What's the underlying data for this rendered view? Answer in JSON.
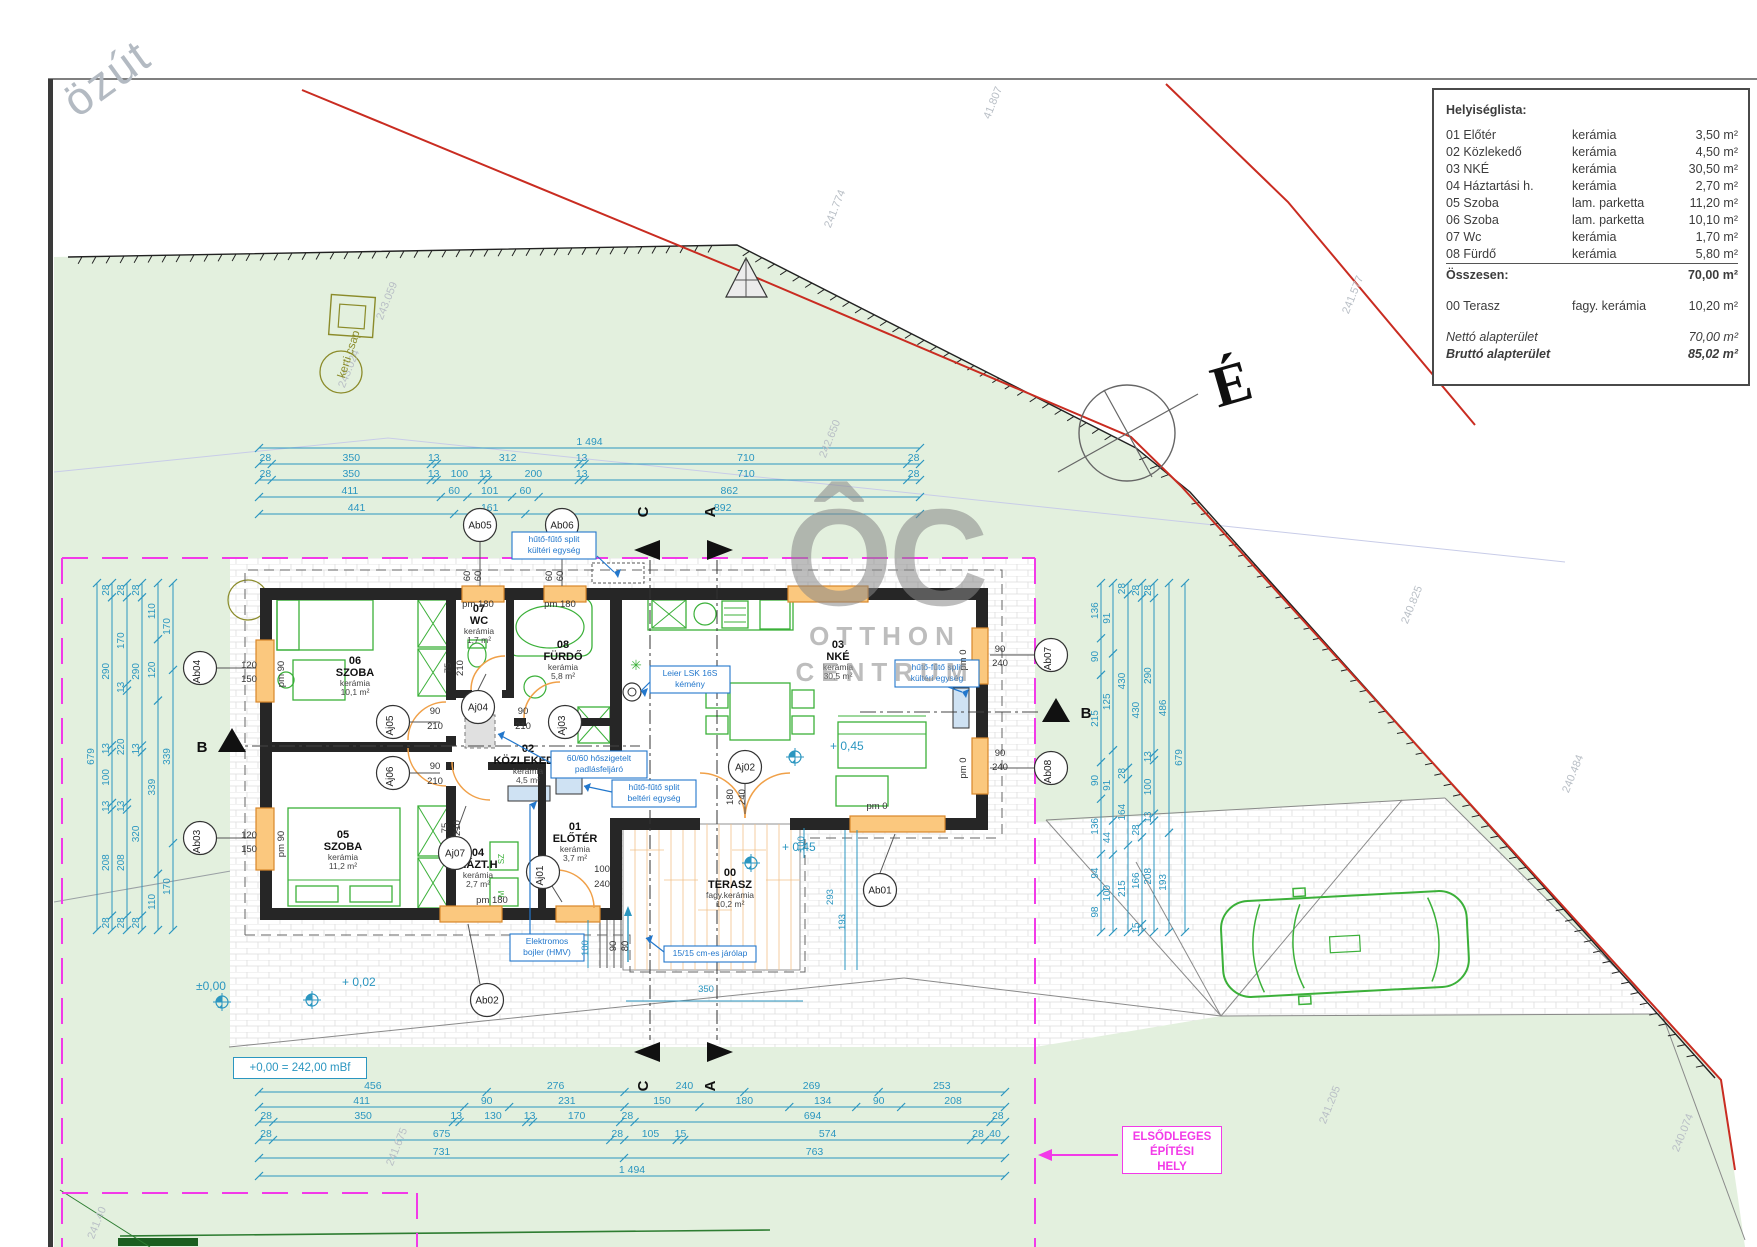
{
  "site": {
    "road_label": "özút",
    "north_letter": "É",
    "garden_tap": "kerti csap",
    "level_reference": "+0,00 = 242,00 mBf",
    "primary_area": [
      "ELSŐDLEGES",
      "ÉPÍTÉSI",
      "HELY"
    ],
    "section_letters": {
      "c": "C",
      "a": "A",
      "b": "B"
    },
    "parcel_numbers": [
      {
        "t": "243.059",
        "x": 390,
        "y": 302
      },
      {
        "t": "243.024",
        "x": 352,
        "y": 370
      },
      {
        "t": "241.774",
        "x": 838,
        "y": 210
      },
      {
        "t": "41.807",
        "x": 996,
        "y": 104
      },
      {
        "t": "241.577",
        "x": 1356,
        "y": 296
      },
      {
        "t": "242.650",
        "x": 833,
        "y": 440
      },
      {
        "t": "240.825",
        "x": 1415,
        "y": 606
      },
      {
        "t": "240.484",
        "x": 1576,
        "y": 775
      },
      {
        "t": "241.205",
        "x": 1333,
        "y": 1106
      },
      {
        "t": "240.074",
        "x": 1686,
        "y": 1134
      },
      {
        "t": "241.675",
        "x": 400,
        "y": 1148
      },
      {
        "t": "241.40",
        "x": 100,
        "y": 1224
      }
    ]
  },
  "watermark": {
    "logo": "ÔC",
    "line1": "OTTHON",
    "line2": "CENTRUM"
  },
  "room_list": {
    "title": "Helyiséglista:",
    "rows": [
      {
        "name": "01 Előtér",
        "material": "kerámia",
        "area": "3,50 m²"
      },
      {
        "name": "02 Közlekedő",
        "material": "kerámia",
        "area": "4,50 m²"
      },
      {
        "name": "03 NKÉ",
        "material": "kerámia",
        "area": "30,50 m²"
      },
      {
        "name": "04 Háztartási h.",
        "material": "kerámia",
        "area": "2,70 m²"
      },
      {
        "name": "05 Szoba",
        "material": "lam. parketta",
        "area": "11,20 m²"
      },
      {
        "name": "06 Szoba",
        "material": "lam. parketta",
        "area": "10,10 m²"
      },
      {
        "name": "07 Wc",
        "material": "kerámia",
        "area": "1,70 m²"
      },
      {
        "name": "08 Fürdő",
        "material": "kerámia",
        "area": "5,80 m²"
      }
    ],
    "total_label": "Összesen:",
    "total_area": "70,00 m²",
    "terrace": {
      "name": "00 Terasz",
      "material": "fagy. kerámia",
      "area": "10,20 m²"
    },
    "net_label": "Nettó alapterület",
    "net_area": "70,00 m²",
    "gross_label": "Bruttó alapterület",
    "gross_area": "85,02 m²"
  },
  "plan": {
    "rooms": [
      {
        "num": "06",
        "name": "SZOBA",
        "mat": "kerámia",
        "area": "10,1 m²",
        "x": 355,
        "y": 664
      },
      {
        "num": "07",
        "name": "WC",
        "mat": "kerámia",
        "area": "1,7 m²",
        "x": 479,
        "y": 612
      },
      {
        "num": "08",
        "name": "FÜRDŐ",
        "mat": "kerámia",
        "area": "5,8 m²",
        "x": 563,
        "y": 648
      },
      {
        "num": "03",
        "name": "NKÉ",
        "mat": "kerámia",
        "area": "30,5 m²",
        "x": 838,
        "y": 648
      },
      {
        "num": "02",
        "name": "KÖZLEKEDŐ",
        "mat": "kerámia",
        "area": "4,5 m²",
        "x": 528,
        "y": 752
      },
      {
        "num": "05",
        "name": "SZOBA",
        "mat": "kerámia",
        "area": "11,2 m²",
        "x": 343,
        "y": 838
      },
      {
        "num": "04",
        "name": "HÁZT.H",
        "mat": "kerámia",
        "area": "2,7 m²",
        "x": 478,
        "y": 856
      },
      {
        "num": "01",
        "name": "ELŐTÉR",
        "mat": "kerámia",
        "area": "3,7 m²",
        "x": 575,
        "y": 830
      },
      {
        "num": "00",
        "name": "TERASZ",
        "mat": "fagy.kerámia",
        "area": "10,2 m²",
        "x": 730,
        "y": 876
      }
    ],
    "tags": [
      {
        "t": "Ab05",
        "x": 480,
        "y": 525,
        "r": 0,
        "l": [
          480,
          542,
          480,
          586
        ]
      },
      {
        "t": "Ab06",
        "x": 562,
        "y": 525,
        "r": 0,
        "l": [
          562,
          542,
          562,
          586
        ]
      },
      {
        "t": "Ab04",
        "x": 200,
        "y": 668,
        "r": -90,
        "l": [
          217,
          668,
          256,
          668
        ]
      },
      {
        "t": "Ab03",
        "x": 200,
        "y": 838,
        "r": -90,
        "l": [
          217,
          838,
          256,
          838
        ]
      },
      {
        "t": "Ab02",
        "x": 487,
        "y": 1000,
        "r": 0,
        "l": [
          480,
          984,
          468,
          924
        ]
      },
      {
        "t": "Ab01",
        "x": 880,
        "y": 890,
        "r": 0,
        "l": [
          880,
          873,
          895,
          834
        ]
      },
      {
        "t": "Ab07",
        "x": 1051,
        "y": 655,
        "r": -90,
        "l": [
          1034,
          655,
          990,
          655
        ]
      },
      {
        "t": "Ab08",
        "x": 1051,
        "y": 768,
        "r": -90,
        "l": [
          1034,
          768,
          990,
          768
        ]
      },
      {
        "t": "Aj05",
        "x": 393,
        "y": 722,
        "r": -90,
        "l": [
          410,
          722,
          440,
          722
        ]
      },
      {
        "t": "Aj04",
        "x": 478,
        "y": 707,
        "r": 0,
        "l": [
          478,
          690,
          486,
          674
        ]
      },
      {
        "t": "Aj03",
        "x": 565,
        "y": 722,
        "r": -90,
        "l": [
          550,
          716,
          557,
          712
        ]
      },
      {
        "t": "Aj06",
        "x": 393,
        "y": 773,
        "r": -90,
        "l": [
          410,
          773,
          440,
          773
        ]
      },
      {
        "t": "Aj07",
        "x": 455,
        "y": 853,
        "r": 0,
        "l": [
          455,
          836,
          466,
          806
        ]
      },
      {
        "t": "Aj01",
        "x": 543,
        "y": 872,
        "r": -90,
        "l": [
          552,
          886,
          562,
          902
        ]
      },
      {
        "t": "Aj02",
        "x": 745,
        "y": 767,
        "r": 0,
        "l": [
          745,
          784,
          745,
          814
        ]
      }
    ],
    "notes": [
      {
        "x": 512,
        "y": 532,
        "w": 84,
        "lines": [
          "hűtő-fűtő split",
          "kültéri egység"
        ],
        "a": [
          597,
          556,
          614,
          572
        ]
      },
      {
        "x": 895,
        "y": 660,
        "w": 84,
        "lines": [
          "hűtő-fűtő split",
          "kültéri egység"
        ],
        "a": [
          940,
          684,
          962,
          692
        ]
      },
      {
        "x": 650,
        "y": 666,
        "w": 80,
        "lines": [
          "Leier LSK 16S",
          "kémény"
        ],
        "a": [
          650,
          682,
          641,
          691
        ]
      },
      {
        "x": 551,
        "y": 751,
        "w": 96,
        "lines": [
          "60/60 hőszigetelt",
          "padlásfeljáró"
        ],
        "a": [
          551,
          763,
          498,
          734
        ]
      },
      {
        "x": 612,
        "y": 780,
        "w": 84,
        "lines": [
          "hűtő-fűtő split",
          "beltéri egység"
        ],
        "a": [
          612,
          792,
          584,
          786
        ]
      },
      {
        "x": 510,
        "y": 934,
        "w": 74,
        "lines": [
          "Elektromos",
          "bojler (HMV)"
        ],
        "a": [
          530,
          934,
          530,
          804
        ]
      },
      {
        "x": 664,
        "y": 946,
        "w": 92,
        "lines": [
          "15/15 cm-es járólap"
        ],
        "a": [
          664,
          952,
          646,
          938
        ]
      }
    ],
    "dim_labels": [
      {
        "t": "90",
        "x": 435,
        "y": 714
      },
      {
        "t": "210",
        "x": 435,
        "y": 729
      },
      {
        "t": "90",
        "x": 523,
        "y": 714
      },
      {
        "t": "210",
        "x": 523,
        "y": 729
      },
      {
        "t": "90",
        "x": 435,
        "y": 769
      },
      {
        "t": "210",
        "x": 435,
        "y": 784
      },
      {
        "t": "75",
        "x": 451,
        "y": 668,
        "r": -90
      },
      {
        "t": "210",
        "x": 463,
        "y": 668,
        "r": -90
      },
      {
        "t": "75",
        "x": 448,
        "y": 828,
        "r": -90
      },
      {
        "t": "210",
        "x": 460,
        "y": 828,
        "r": -90
      },
      {
        "t": "180",
        "x": 733,
        "y": 797,
        "r": -90
      },
      {
        "t": "240",
        "x": 745,
        "y": 797,
        "r": -90
      },
      {
        "t": "100",
        "x": 602,
        "y": 872
      },
      {
        "t": "240",
        "x": 602,
        "y": 887
      },
      {
        "t": "120",
        "x": 249,
        "y": 668
      },
      {
        "t": "150",
        "x": 249,
        "y": 682
      },
      {
        "t": "120",
        "x": 249,
        "y": 838
      },
      {
        "t": "150",
        "x": 249,
        "y": 852
      },
      {
        "t": "pm 90",
        "x": 284,
        "y": 674,
        "r": -90
      },
      {
        "t": "pm 90",
        "x": 284,
        "y": 844,
        "r": -90
      },
      {
        "t": "pm 180",
        "x": 478,
        "y": 607
      },
      {
        "t": "pm 180",
        "x": 560,
        "y": 607
      },
      {
        "t": "pm 180",
        "x": 492,
        "y": 903
      },
      {
        "t": "pm 0",
        "x": 966,
        "y": 660,
        "r": -90
      },
      {
        "t": "pm 0",
        "x": 966,
        "y": 768,
        "r": -90
      },
      {
        "t": "pm 0",
        "x": 877,
        "y": 809
      },
      {
        "t": "90",
        "x": 1000,
        "y": 652
      },
      {
        "t": "240",
        "x": 1000,
        "y": 666
      },
      {
        "t": "90",
        "x": 1000,
        "y": 756
      },
      {
        "t": "240",
        "x": 1000,
        "y": 770
      },
      {
        "t": "60",
        "x": 470,
        "y": 576,
        "r": -90
      },
      {
        "t": "60",
        "x": 481,
        "y": 576,
        "r": -90
      },
      {
        "t": "60",
        "x": 552,
        "y": 576,
        "r": -90
      },
      {
        "t": "60",
        "x": 563,
        "y": 576,
        "r": -90
      },
      {
        "t": "90",
        "x": 616,
        "y": 946,
        "r": -90
      },
      {
        "t": "80",
        "x": 628,
        "y": 946,
        "r": -90
      },
      {
        "t": "100",
        "x": 588,
        "y": 948,
        "r": -90,
        "c": 1
      },
      {
        "t": "100",
        "x": 804,
        "y": 844,
        "r": -90,
        "c": 1
      },
      {
        "t": "293",
        "x": 833,
        "y": 897,
        "r": -90,
        "c": 1
      },
      {
        "t": "193",
        "x": 845,
        "y": 922,
        "r": -90,
        "c": 1
      },
      {
        "t": "350",
        "x": 706,
        "y": 992,
        "c": 1
      }
    ],
    "elevations": [
      {
        "t": "±0,00",
        "x": 196,
        "y": 990,
        "mx": 222,
        "my": 1002
      },
      {
        "t": "+ 0,02",
        "x": 342,
        "y": 986,
        "mx": 312,
        "my": 1000
      },
      {
        "t": "+ 0,45",
        "x": 830,
        "y": 750,
        "mx": 795,
        "my": 757
      },
      {
        "t": "+ 0,45",
        "x": 782,
        "y": 851,
        "mx": 751,
        "my": 863
      }
    ],
    "chains": {
      "top": {
        "x1": 259,
        "x2": 920,
        "rows": [
          {
            "y": 448,
            "v": [
              "1 494"
            ]
          },
          {
            "y": 464,
            "v": [
              "28",
              "350",
              "13",
              "312",
              "13",
              "710",
              "28"
            ]
          },
          {
            "y": 480,
            "v": [
              "28",
              "350",
              "13",
              "100",
              "13",
              "200",
              "13",
              "710",
              "28"
            ]
          },
          {
            "y": 497,
            "v": [
              "411",
              "60",
              "101",
              "60",
              "862"
            ]
          },
          {
            "y": 514,
            "v": [
              "441",
              "161",
              "892"
            ]
          }
        ]
      },
      "bottom": {
        "x1": 259,
        "x2": 1005,
        "rows": [
          {
            "y": 1092,
            "v": [
              "456",
              "276",
              "240",
              "269",
              "253"
            ]
          },
          {
            "y": 1107,
            "v": [
              "411",
              "90",
              "231",
              "150",
              "180",
              "134",
              "90",
              "208"
            ]
          },
          {
            "y": 1122,
            "v": [
              "28",
              "350",
              "13",
              "130",
              "13",
              "170",
              "28",
              "694",
              "28"
            ]
          },
          {
            "y": 1140,
            "v": [
              "28",
              "675",
              "28",
              "105",
              "15",
              "574",
              "28",
              "40"
            ]
          },
          {
            "y": 1158,
            "v": [
              "731",
              "763"
            ]
          },
          {
            "y": 1176,
            "v": [
              "1 494"
            ]
          }
        ]
      },
      "left": {
        "y1": 583,
        "y2": 930,
        "cols": [
          {
            "x": 97,
            "v": [
              "679"
            ]
          },
          {
            "x": 112,
            "v": [
              "28",
              "290",
              "13",
              "100",
              "13",
              "208",
              "28"
            ]
          },
          {
            "x": 127,
            "v": [
              "28",
              "170",
              "13",
              "220",
              "13",
              "208",
              "28"
            ]
          },
          {
            "x": 142,
            "v": [
              "28",
              "290",
              "13",
              "320",
              "28"
            ]
          },
          {
            "x": 158,
            "v": [
              "110",
              "120",
              "339",
              "110"
            ]
          },
          {
            "x": 173,
            "v": [
              "170",
              "339",
              "170"
            ]
          }
        ]
      },
      "right": {
        "y1": 583,
        "y2": 932,
        "cols": [
          {
            "x": 1101,
            "v": [
              "136",
              "90",
              "215",
              "90",
              "136",
              "94",
              "98"
            ]
          },
          {
            "x": 1113,
            "v": [
              "91",
              "125",
              "91",
              "44",
              "100"
            ]
          },
          {
            "x": 1128,
            "v": [
              "28",
              "430",
              "28",
              "164",
              "215"
            ]
          },
          {
            "x": 1142,
            "v": [
              "28",
              "430",
              "28",
              "166",
              "15"
            ]
          },
          {
            "x": 1154,
            "v": [
              "28",
              "290",
              "13",
              "100",
              "13",
              "208"
            ]
          },
          {
            "x": 1169,
            "v": [
              "486",
              "193"
            ]
          },
          {
            "x": 1185,
            "v": [
              "679"
            ]
          }
        ]
      }
    }
  }
}
